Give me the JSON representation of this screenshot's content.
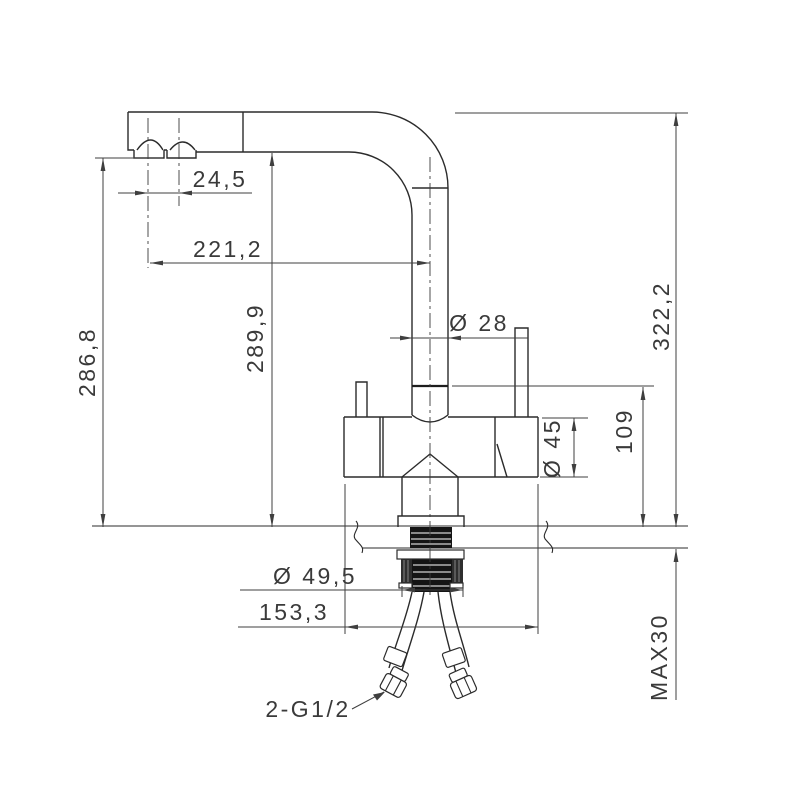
{
  "drawing": {
    "title": "faucet-technical-drawing",
    "units_style": "millimeters-comma-decimal",
    "colors": {
      "background": "#ffffff",
      "object_line": "#2b2b2b",
      "dimension_line": "#3f3f3f",
      "text": "#3a3a3a",
      "thread_fill": "#141414"
    },
    "dimensions": {
      "nozzle_spacing": "24,5",
      "spout_reach": "221,2",
      "height_to_aerator": "286,8",
      "height_under_spout": "289,9",
      "total_height": "322,2",
      "spout_pipe_diameter": "Ø 28",
      "body_diameter": "Ø 45",
      "body_top_to_deck": "109",
      "max_deck_thickness": "MAX30",
      "mounting_diameter": "Ø 49,5",
      "body_length": "153,3",
      "hose_thread": "2-G1/2"
    }
  }
}
